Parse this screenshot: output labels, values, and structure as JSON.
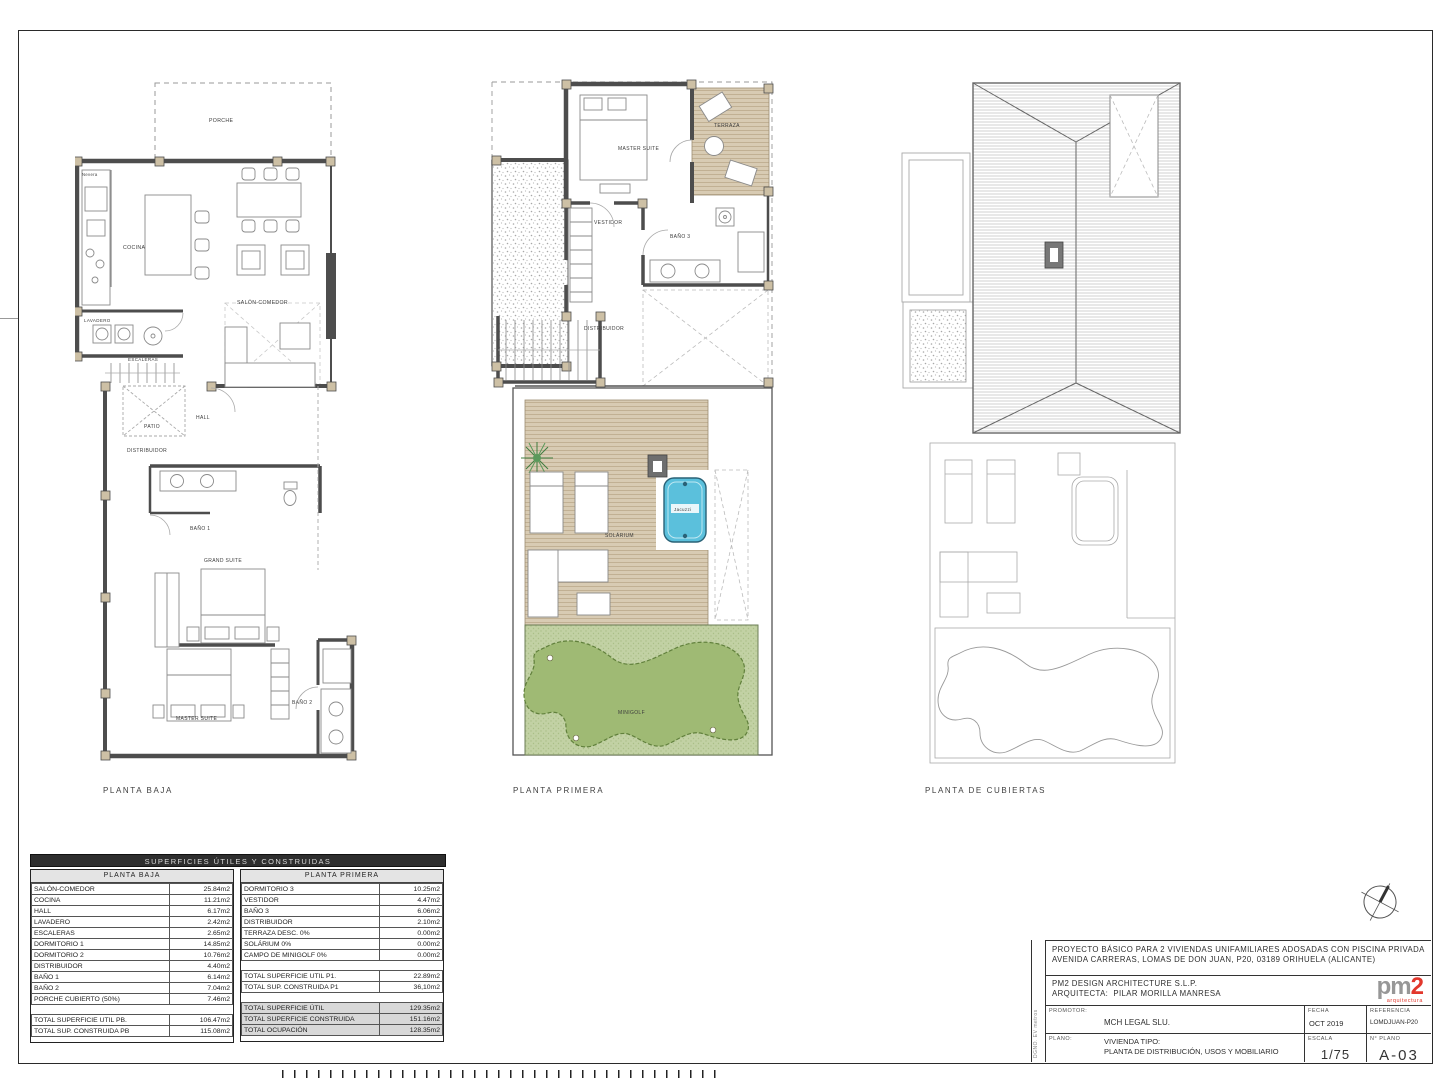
{
  "sheet": {
    "plan_labels": {
      "baja": "PLANTA BAJA",
      "primera": "PLANTA PRIMERA",
      "cubiertas": "PLANTA DE CUBIERTAS"
    },
    "side_note": "DGNO. EV metros"
  },
  "plans": {
    "baja": {
      "rooms": {
        "porche": "PORCHE",
        "nevera": "Nevera",
        "cocina": "COCINA",
        "salon": "SALÓN-COMEDOR",
        "lavadero": "LAVADERO",
        "escaleras": "ESCALERAS",
        "patio": "PATIO",
        "hall": "HALL",
        "distribuidor": "DISTRIBUIDOR",
        "bano1": "BAÑO 1",
        "grand_suite": "GRAND SUITE",
        "master_suite": "MASTER SUITE",
        "bano2": "BAÑO 2"
      }
    },
    "primera": {
      "rooms": {
        "master_suite": "MASTER SUITE",
        "terraza": "TERRAZA",
        "vestidor": "VESTIDOR",
        "bano3": "BAÑO 3",
        "distribuidor": "DISTRIBUIDOR",
        "solarium": "SOLÁRIUM",
        "jacuzzi": "Jacuzzi",
        "minigolf": "MINIGOLF"
      }
    }
  },
  "areas_table": {
    "title": "SUPERFICIES ÚTILES Y CONSTRUIDAS",
    "left": {
      "header": "PLANTA BAJA",
      "rows": [
        [
          "SALÓN-COMEDOR",
          "25.84m2"
        ],
        [
          "COCINA",
          "11.21m2"
        ],
        [
          "HALL",
          "6.17m2"
        ],
        [
          "LAVADERO",
          "2.42m2"
        ],
        [
          "ESCALERAS",
          "2.65m2"
        ],
        [
          "DORMITORIO 1",
          "14.85m2"
        ],
        [
          "DORMITORIO 2",
          "10.76m2"
        ],
        [
          "DISTRIBUIDOR",
          "4.40m2"
        ],
        [
          "BAÑO 1",
          "6.14m2"
        ],
        [
          "BAÑO 2",
          "7.04m2"
        ],
        [
          "PORCHE CUBIERTO (50%)",
          "7.46m2"
        ]
      ],
      "totals": [
        [
          "TOTAL SUPERFICIE UTIL PB.",
          "106.47m2"
        ],
        [
          "TOTAL SUP. CONSTRUIDA PB",
          "115.08m2"
        ]
      ]
    },
    "right": {
      "header": "PLANTA PRIMERA",
      "rows": [
        [
          "DORMITORIO 3",
          "10.25m2"
        ],
        [
          "VESTIDOR",
          "4.47m2"
        ],
        [
          "BAÑO 3",
          "6.06m2"
        ],
        [
          "DISTRIBUIDOR",
          "2.10m2"
        ],
        [
          "TERRAZA DESC. 0%",
          "0.00m2"
        ],
        [
          "SOLÁRIUM 0%",
          "0.00m2"
        ],
        [
          "CAMPO DE MINIGOLF 0%",
          "0.00m2"
        ]
      ],
      "totals": [
        [
          "TOTAL SUPERFICIE UTIL P1.",
          "22.89m2"
        ],
        [
          "TOTAL SUP. CONSTRUIDA P1",
          "36,10m2"
        ]
      ],
      "grand_totals": [
        [
          "TOTAL SUPERFICIE ÚTIL",
          "129.35m2"
        ],
        [
          "TOTAL SUPERFICIE CONSTRUIDA",
          "151.16m2"
        ],
        [
          "TOTAL OCUPACIÓN",
          "128.35m2"
        ]
      ]
    }
  },
  "title_block": {
    "project_line1": "PROYECTO BÁSICO PARA 2 VIVIENDAS UNIFAMILIARES ADOSADAS CON PISCINA PRIVADA",
    "project_line2": "AVENIDA CARRERAS, LOMAS DE DON JUAN, P20, 03189 ORIHUELA (ALICANTE)",
    "studio": "PM2 DESIGN ARCHITECTURE S.L.P.",
    "architect_label": "ARQUITECTA:",
    "architect": "PILAR MORILLA MANRESA",
    "logo": {
      "gray": "pm",
      "red": "2",
      "tagline": "arquitectura"
    },
    "promotor_label": "PROMOTOR:",
    "promotor": "MCH LEGAL SLU.",
    "fecha_label": "FECHA",
    "fecha": "OCT 2019",
    "referencia_label": "REFERENCIA",
    "referencia": "LOMDJUAN-P20",
    "plano_label": "PLANO:",
    "plano_line1": "VIVIENDA TIPO:",
    "plano_line2": "PLANTA DE DISTRIBUCIÓN, USOS Y MOBILIARIO",
    "escala_label": "ESCALA",
    "escala": "1/75",
    "num_plano_label": "N° PLANO",
    "num_plano": "A-03"
  },
  "colors": {
    "wall": "#4d4d4d",
    "post": "#cdc0a5",
    "deck": "#d8cbb3",
    "golf_field": "#c2d1a4",
    "golf_green": "#9fba74",
    "golf_edge": "#61803c",
    "jacuzzi": "#5bc0dc",
    "jacuzzi_edge": "#2a6277",
    "logo_red": "#e2372c"
  }
}
